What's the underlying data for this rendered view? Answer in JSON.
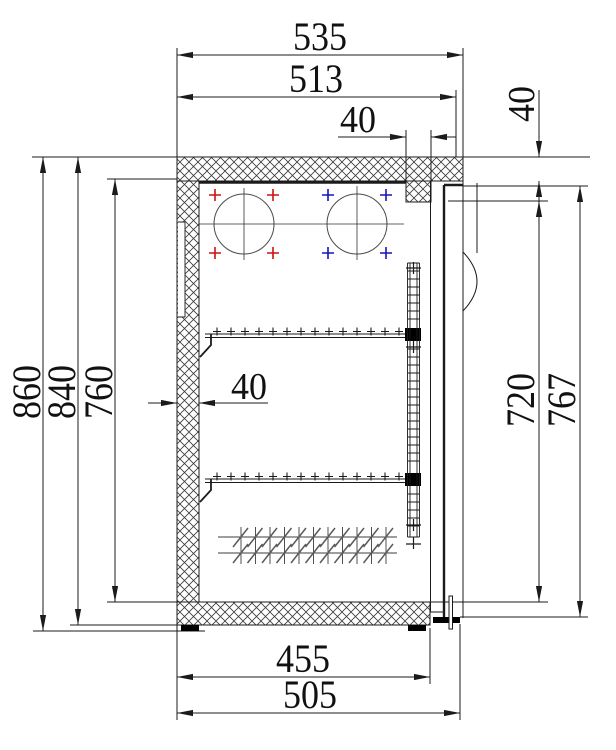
{
  "drawing": {
    "kind": "technical cross-section of refrigerated cabinet",
    "dimensions": {
      "width_overall": "535",
      "width_top_inner": "513",
      "mullion_width": "40",
      "top_step_height": "40",
      "height_overall": "860",
      "height_body": "840",
      "height_interior": "760",
      "wall_thickness": "40",
      "door_opening_height": "720",
      "door_height": "767",
      "depth_inner": "455",
      "depth_overall": "505"
    },
    "colors": {
      "line": "#1b1b1b",
      "hatch": "#3a3a3a",
      "circle": "#4a4a4a",
      "marker_red": "#cc1111",
      "marker_blue": "#1515bb",
      "background": "#ffffff"
    }
  }
}
